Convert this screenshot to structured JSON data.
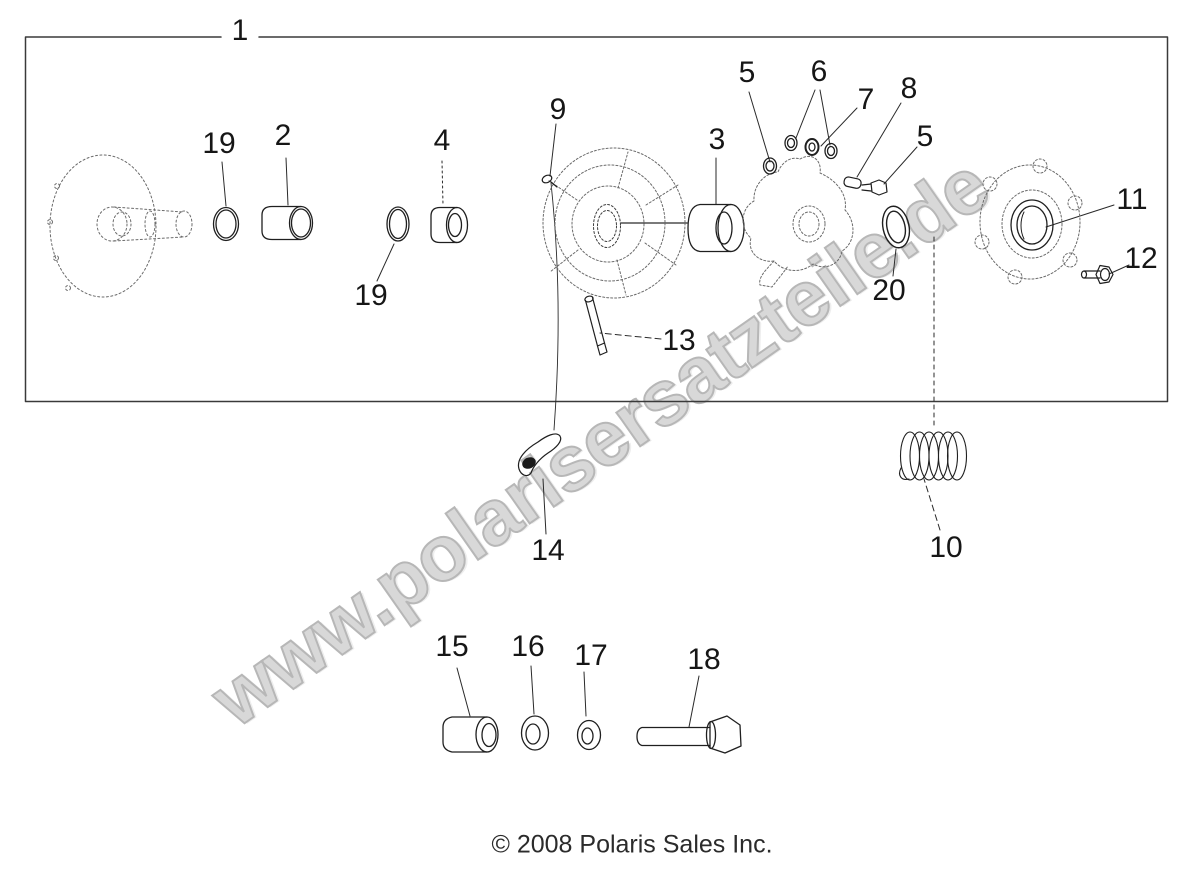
{
  "watermark": {
    "text": "www.polarisersatzteile.de",
    "fill": "#d8d8d8",
    "outline": "#b7b7b7"
  },
  "footer": {
    "copyright": "© 2008 Polaris Sales Inc."
  },
  "diagram": {
    "background": "#ffffff",
    "line_color": "#1f1f1f",
    "sketch_color": "#6b6b6b",
    "callouts": [
      {
        "part": "1",
        "label": "1"
      },
      {
        "part": "19",
        "label": "19"
      },
      {
        "part": "2",
        "label": "2"
      },
      {
        "part": "4",
        "label": "4"
      },
      {
        "part": "19",
        "label": "19"
      },
      {
        "part": "9",
        "label": "9"
      },
      {
        "part": "3",
        "label": "3"
      },
      {
        "part": "5",
        "label": "5"
      },
      {
        "part": "6",
        "label": "6"
      },
      {
        "part": "7",
        "label": "7"
      },
      {
        "part": "8",
        "label": "8"
      },
      {
        "part": "5",
        "label": "5"
      },
      {
        "part": "11",
        "label": "11"
      },
      {
        "part": "12",
        "label": "12"
      },
      {
        "part": "20",
        "label": "20"
      },
      {
        "part": "13",
        "label": "13"
      },
      {
        "part": "14",
        "label": "14"
      },
      {
        "part": "10",
        "label": "10"
      },
      {
        "part": "15",
        "label": "15"
      },
      {
        "part": "16",
        "label": "16"
      },
      {
        "part": "17",
        "label": "17"
      },
      {
        "part": "18",
        "label": "18"
      }
    ]
  }
}
